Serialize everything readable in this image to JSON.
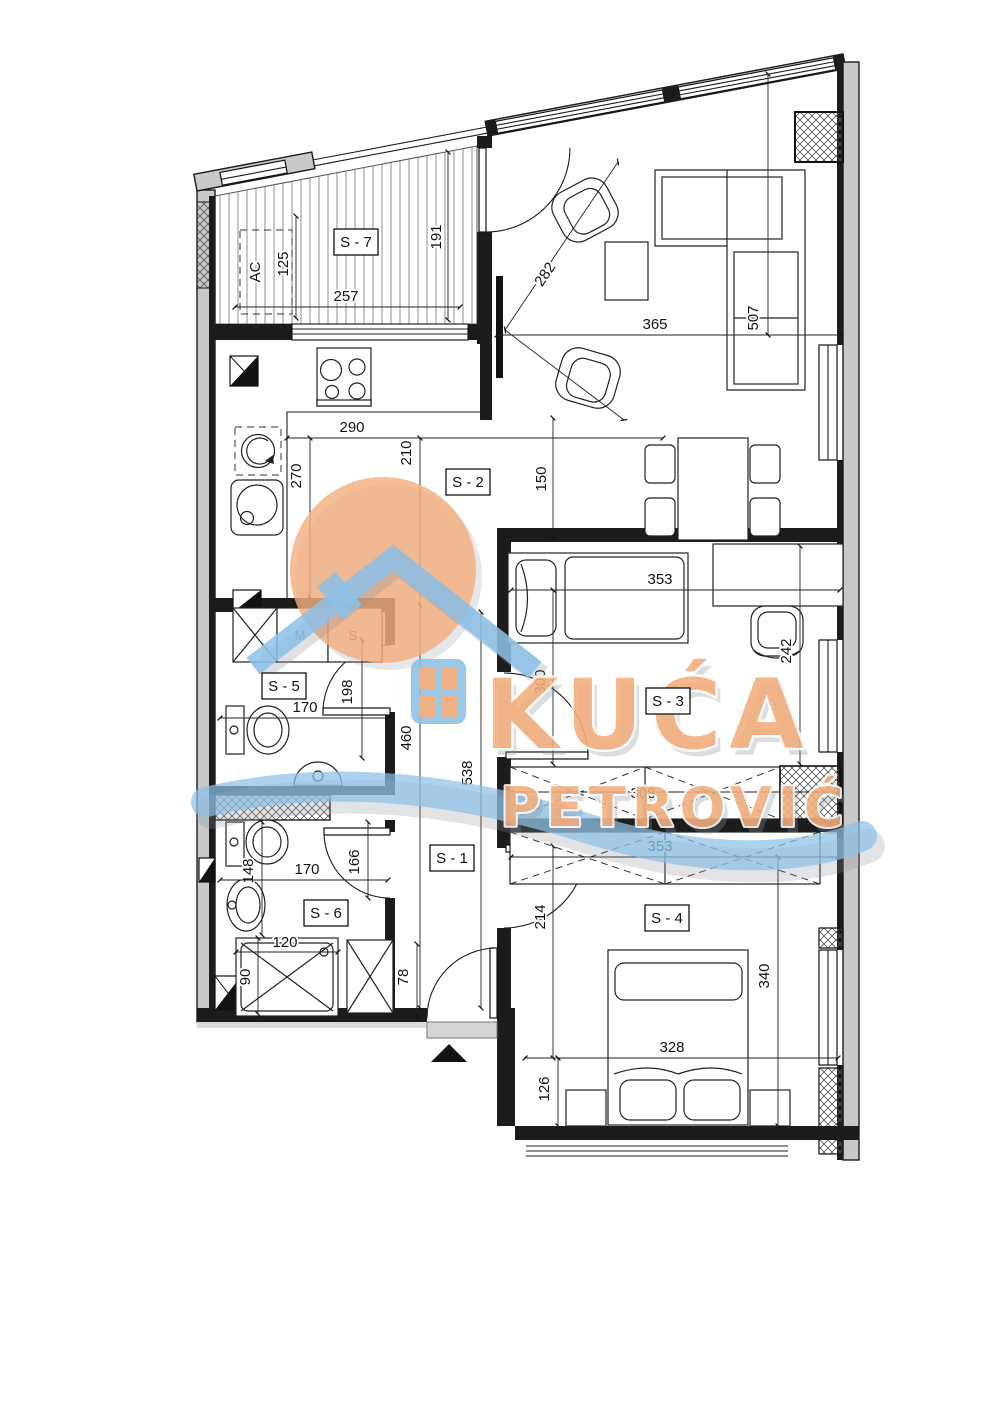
{
  "page": {
    "background": "#ffffff"
  },
  "colors": {
    "wall_fill": "#c9c9c9",
    "line": "#1c1c1c",
    "watermark_orange": "#F2AE7C",
    "watermark_blue": "#8CC0E6"
  },
  "watermark": {
    "brand_top": "KUĆA",
    "brand_bottom": "PETROVIĆ"
  },
  "rooms": {
    "s1": "S - 1",
    "s2": "S - 2",
    "s3": "S - 3",
    "s4": "S - 4",
    "s5": "S - 5",
    "s6": "S - 6",
    "s7": "S - 7"
  },
  "appliances": {
    "ac": "AC",
    "washer": "M",
    "dryer": "S"
  },
  "dims": {
    "terrace_width": "257",
    "terrace_depth": "191",
    "ac_width": "125",
    "kitchen_width": "290",
    "kitchen_depth": "210",
    "counter_run": "270",
    "dining_clear": "150",
    "living_width": "365",
    "living_diag": "282",
    "sofa_run": "507",
    "s3_width": "353",
    "s3_depth": "300",
    "desk_run": "242",
    "wardrobe_s3": "308",
    "wardrobe_s4": "353",
    "s4_entry": "214",
    "s4_depth": "340",
    "s4_width": "328",
    "bed_offset": "126",
    "bath1_width": "170",
    "bath1_door": "198",
    "corridor_a": "460",
    "corridor_b": "538",
    "bath2_side": "148",
    "bath2_width": "170",
    "bath2_door": "166",
    "tub_len": "120",
    "tub_dep": "90",
    "entry_door": "78"
  }
}
